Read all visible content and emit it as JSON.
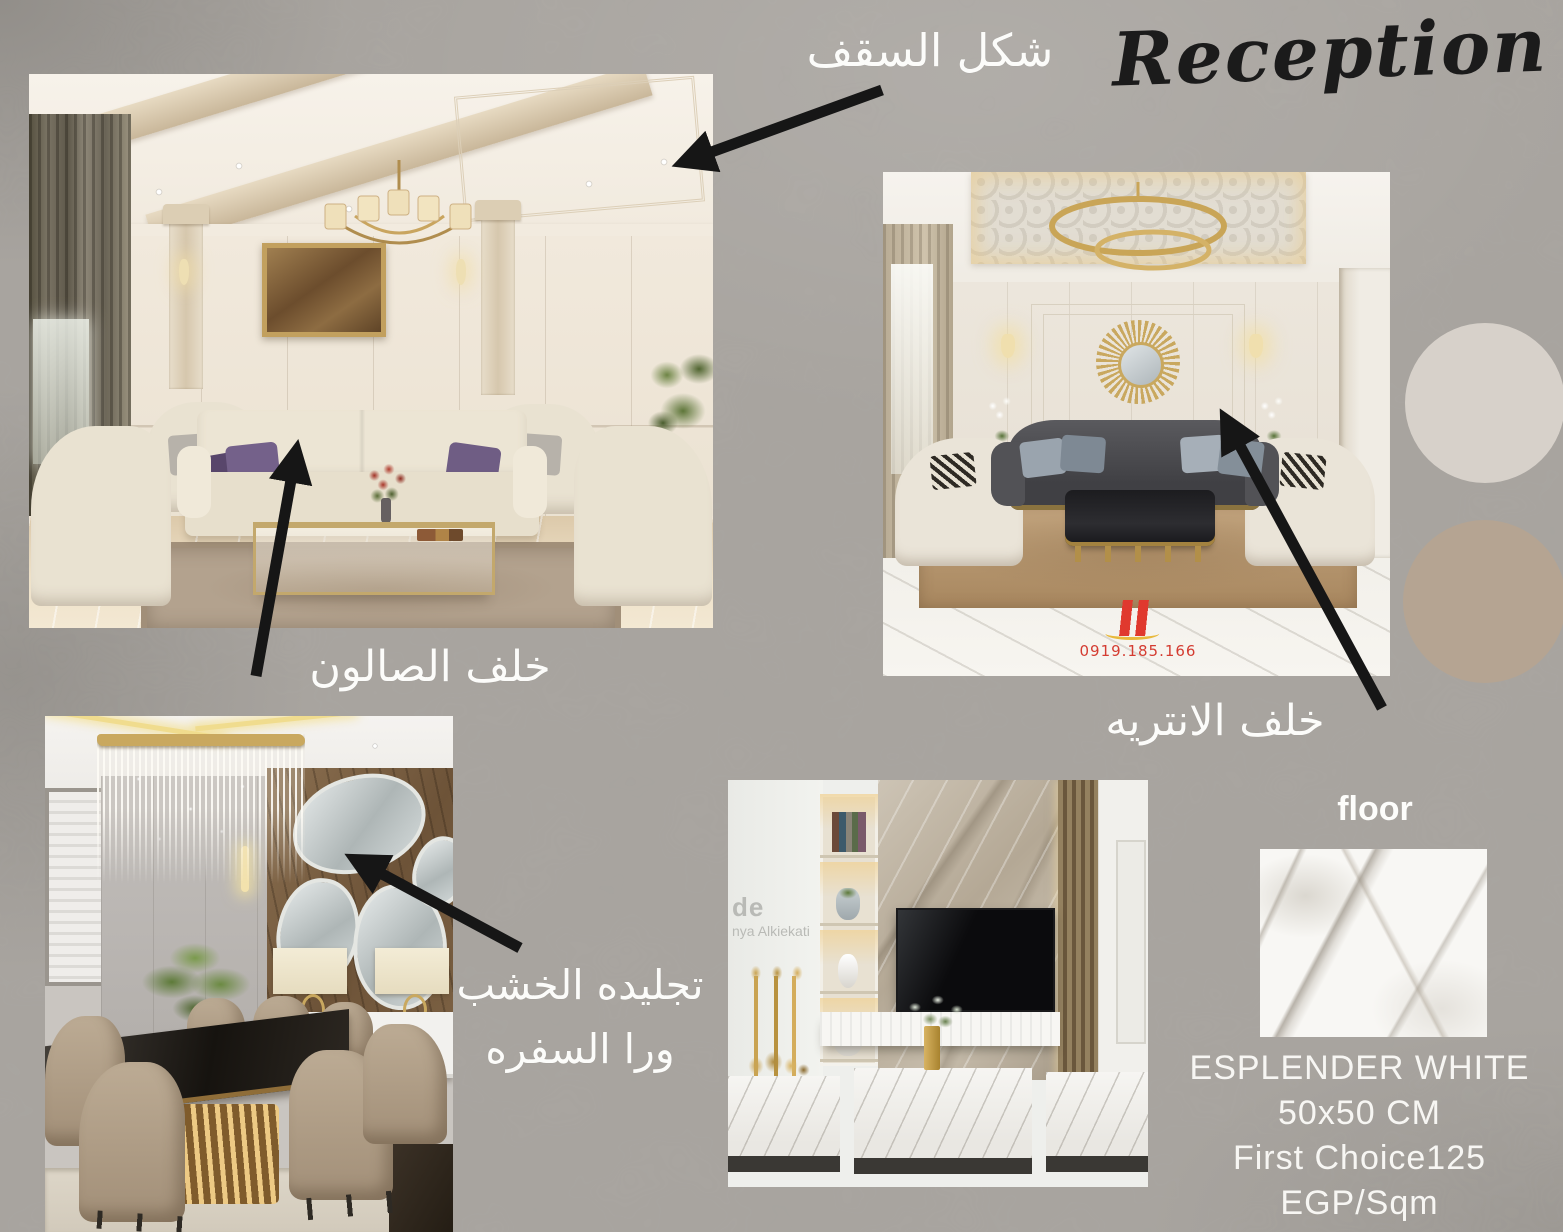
{
  "page": {
    "title_script": "Reception"
  },
  "annotations": {
    "ceiling_label": "شكل السقف",
    "salon_label": "خلف الصالون",
    "entry_label": "خلف الانتريه",
    "wood_label_line1": "تجليده الخشب",
    "wood_label_line2": "ورا السفره"
  },
  "floor_spec": {
    "label": "floor",
    "product": "ESPLENDER WHITE",
    "size": "50x50 CM",
    "price": "First Choice125 EGP/Sqm"
  },
  "photo2_watermark": {
    "phone": "0919.185.166"
  },
  "photo4_watermark": {
    "line1": "de",
    "line2": "nya Alkiekati"
  },
  "palette": {
    "background": "#a9a5a0",
    "swatch_light": "#d7d1ca",
    "swatch_dark": "#b5a492",
    "arrow_color": "#161616",
    "label_color": "#fcfcfa",
    "title_color": "#1b1b1b"
  }
}
